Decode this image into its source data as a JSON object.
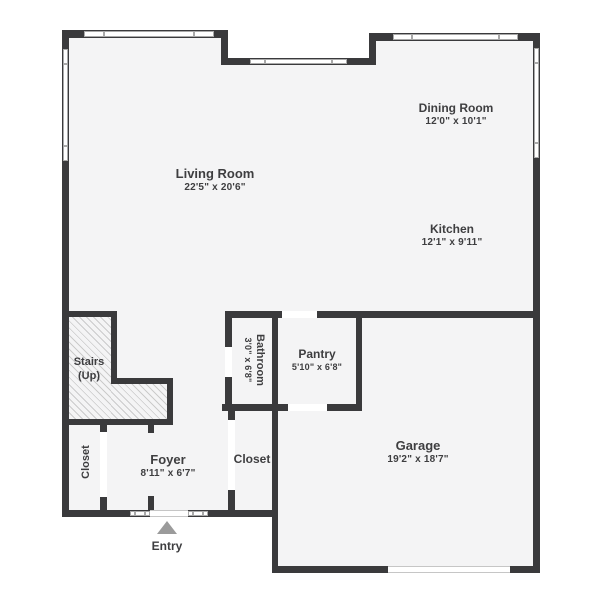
{
  "plan": {
    "rooms": {
      "living_room": {
        "name": "Living Room",
        "dims": "22'5\" x 20'6\""
      },
      "dining_room": {
        "name": "Dining Room",
        "dims": "12'0\" x 10'1\""
      },
      "kitchen": {
        "name": "Kitchen",
        "dims": "12'1\" x 9'11\""
      },
      "pantry": {
        "name": "Pantry",
        "dims": "5'10\" x 6'8\""
      },
      "bathroom": {
        "name": "Bathroom",
        "dims": "3'0\" x 6'8\""
      },
      "garage": {
        "name": "Garage",
        "dims": "19'2\" x 18'7\""
      },
      "foyer": {
        "name": "Foyer",
        "dims": "8'11\" x 6'7\""
      },
      "stairs": {
        "name": "Stairs",
        "sub": "(Up)"
      },
      "closet_left": {
        "name": "Closet"
      },
      "closet_hall": {
        "name": "Closet"
      }
    },
    "entry_label": "Entry"
  },
  "colors": {
    "wall": "#3a3a3c",
    "floor": "#f4f4f5",
    "win": "#a9a9a9",
    "text": "#3e3e40",
    "arrow": "#9b9b9b",
    "hatch": "#cbcbcb"
  }
}
